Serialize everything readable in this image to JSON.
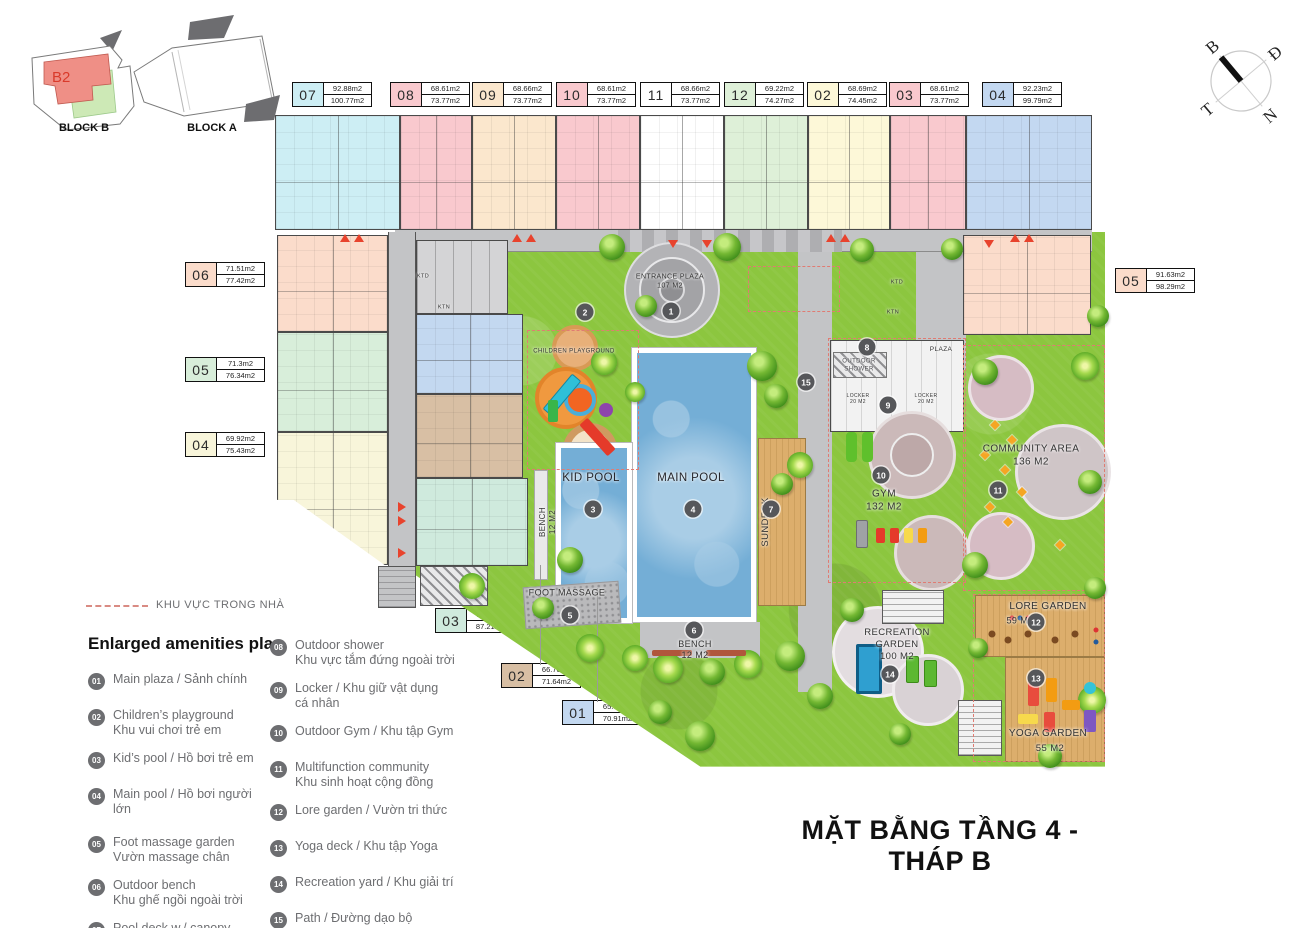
{
  "title": "MẶT BẰNG TẦNG 4 - THÁP B",
  "key_plan": {
    "unit_tag": "B2",
    "block_b": "BLOCK B",
    "block_a": "BLOCK A"
  },
  "compass": {
    "north": "B",
    "east": "Đ",
    "south": "N",
    "west": "T"
  },
  "unit_labels": {
    "top": [
      {
        "id": "07",
        "area_net": "92.88m2",
        "area_gross": "100.77m2",
        "color": "#cdeef4"
      },
      {
        "id": "08",
        "area_net": "68.61m2",
        "area_gross": "73.77m2",
        "color": "#f9c9ce"
      },
      {
        "id": "09",
        "area_net": "68.66m2",
        "area_gross": "73.77m2",
        "color": "#fbe7cd"
      },
      {
        "id": "10",
        "area_net": "68.61m2",
        "area_gross": "73.77m2",
        "color": "#f9c9ce"
      },
      {
        "id": "11",
        "area_net": "68.66m2",
        "area_gross": "73.77m2",
        "color": "#ffffff"
      },
      {
        "id": "12",
        "area_net": "69.22m2",
        "area_gross": "74.27m2",
        "color": "#def0d8"
      },
      {
        "id": "02",
        "area_net": "68.69m2",
        "area_gross": "74.45m2",
        "color": "#fdf8d8"
      },
      {
        "id": "03",
        "area_net": "68.61m2",
        "area_gross": "73.77m2",
        "color": "#f9c9ce"
      },
      {
        "id": "04",
        "area_net": "92.23m2",
        "area_gross": "99.79m2",
        "color": "#c3d8f1"
      }
    ],
    "left": [
      {
        "id": "06",
        "area_net": "71.51m2",
        "area_gross": "77.42m2",
        "color": "#fbdccb"
      },
      {
        "id": "05",
        "area_net": "71.3m2",
        "area_gross": "76.34m2",
        "color": "#d8eeda"
      },
      {
        "id": "04",
        "area_net": "69.92m2",
        "area_gross": "75.43m2",
        "color": "#f8f5da"
      }
    ],
    "right": [
      {
        "id": "05",
        "area_net": "91.63m2",
        "area_gross": "98.29m2",
        "color": "#fbdccb"
      }
    ],
    "bottom": [
      {
        "id": "03",
        "area_net": "79.97m2",
        "area_gross": "87.21m2",
        "color": "#cfeadd"
      },
      {
        "id": "02",
        "area_net": "66.70m2",
        "area_gross": "71.64m2",
        "color": "#d8bfa4"
      },
      {
        "id": "01",
        "area_net": "65.94m2",
        "area_gross": "70.91m2",
        "color": "#c3d8f0"
      }
    ]
  },
  "plan": {
    "markers": [
      "1",
      "2",
      "3",
      "4",
      "5",
      "6",
      "7",
      "8",
      "9",
      "10",
      "11",
      "12",
      "13",
      "14",
      "15"
    ],
    "labels": {
      "entrance_plaza_1": "ENTRANCE PLAZA",
      "entrance_plaza_2": "107 M2",
      "children_playground": "CHILDREN PLAYGROUND",
      "kid_pool": "KID POOL",
      "main_pool": "MAIN POOL",
      "sundeck": "SUNDECK",
      "bench_1": "BENCH",
      "bench_2": "12 M2",
      "foot_massage": "FOOT MASSAGE",
      "outdoor_shower_1": "OUTDOOR",
      "outdoor_shower_2": "SHOWER",
      "locker_1": "LOCKER",
      "locker_2": "20 M2",
      "plaza": "PLAZA",
      "gym_1": "GYM",
      "gym_2": "132 M2",
      "community_1": "COMMUNITY AREA",
      "community_2": "136 M2",
      "lore_1": "LORE GARDEN",
      "lore_2": "59 M2",
      "recreation_1": "RECREATION",
      "recreation_2": "GARDEN",
      "recreation_3": "100 M2",
      "yoga_1": "YOGA GARDEN",
      "yoga_2": "55 M2",
      "ktd": "KTD",
      "ktn": "KTN"
    }
  },
  "legend": {
    "indoor_note": "KHU VỰC TRONG NHÀ",
    "heading": "Enlarged amenities plan",
    "col1": [
      {
        "num": "01",
        "line1": "Main plaza / Sảnh chính",
        "line2": ""
      },
      {
        "num": "02",
        "line1": "Children’s playground",
        "line2": "Khu vui chơi trẻ em"
      },
      {
        "num": "03",
        "line1": "Kid’s pool / Hồ bơi trẻ em",
        "line2": ""
      },
      {
        "num": "04",
        "line1": "Main pool / Hồ bơi người lớn",
        "line2": ""
      },
      {
        "num": "05",
        "line1": "Foot massage garden",
        "line2": "Vườn massage chân"
      },
      {
        "num": "06",
        "line1": "Outdoor bench",
        "line2": "Khu ghế ngồi ngoài trời"
      },
      {
        "num": "07",
        "line1": "Pool deck w./ canopy",
        "line2": "Khu khởi động có mái che"
      }
    ],
    "col2": [
      {
        "num": "08",
        "line1": "Outdoor shower",
        "line2": "Khu vực tắm đứng ngoài trời"
      },
      {
        "num": "09",
        "line1": "Locker / Khu giữ vật dụng",
        "line2": "cá nhân"
      },
      {
        "num": "10",
        "line1": "Outdoor Gym / Khu tập Gym",
        "line2": ""
      },
      {
        "num": "11",
        "line1": "Multifunction community",
        "line2": "Khu sinh hoạt cộng đồng"
      },
      {
        "num": "12",
        "line1": "Lore garden / Vườn tri thức",
        "line2": ""
      },
      {
        "num": "13",
        "line1": "Yoga deck / Khu tập Yoga",
        "line2": ""
      },
      {
        "num": "14",
        "line1": "Recreation yard / Khu giải trí",
        "line2": ""
      },
      {
        "num": "15",
        "line1": "Path / Đường dạo bộ",
        "line2": ""
      }
    ]
  },
  "colors": {
    "grass": "#8cc63f",
    "pool": "#74aed6",
    "deck_wood": "#dcae6c",
    "paving": "#c3c4c6",
    "marker_bg": "#56575a",
    "legend_circle": "#6d6e71",
    "indoor_dash": "#e07b72"
  }
}
